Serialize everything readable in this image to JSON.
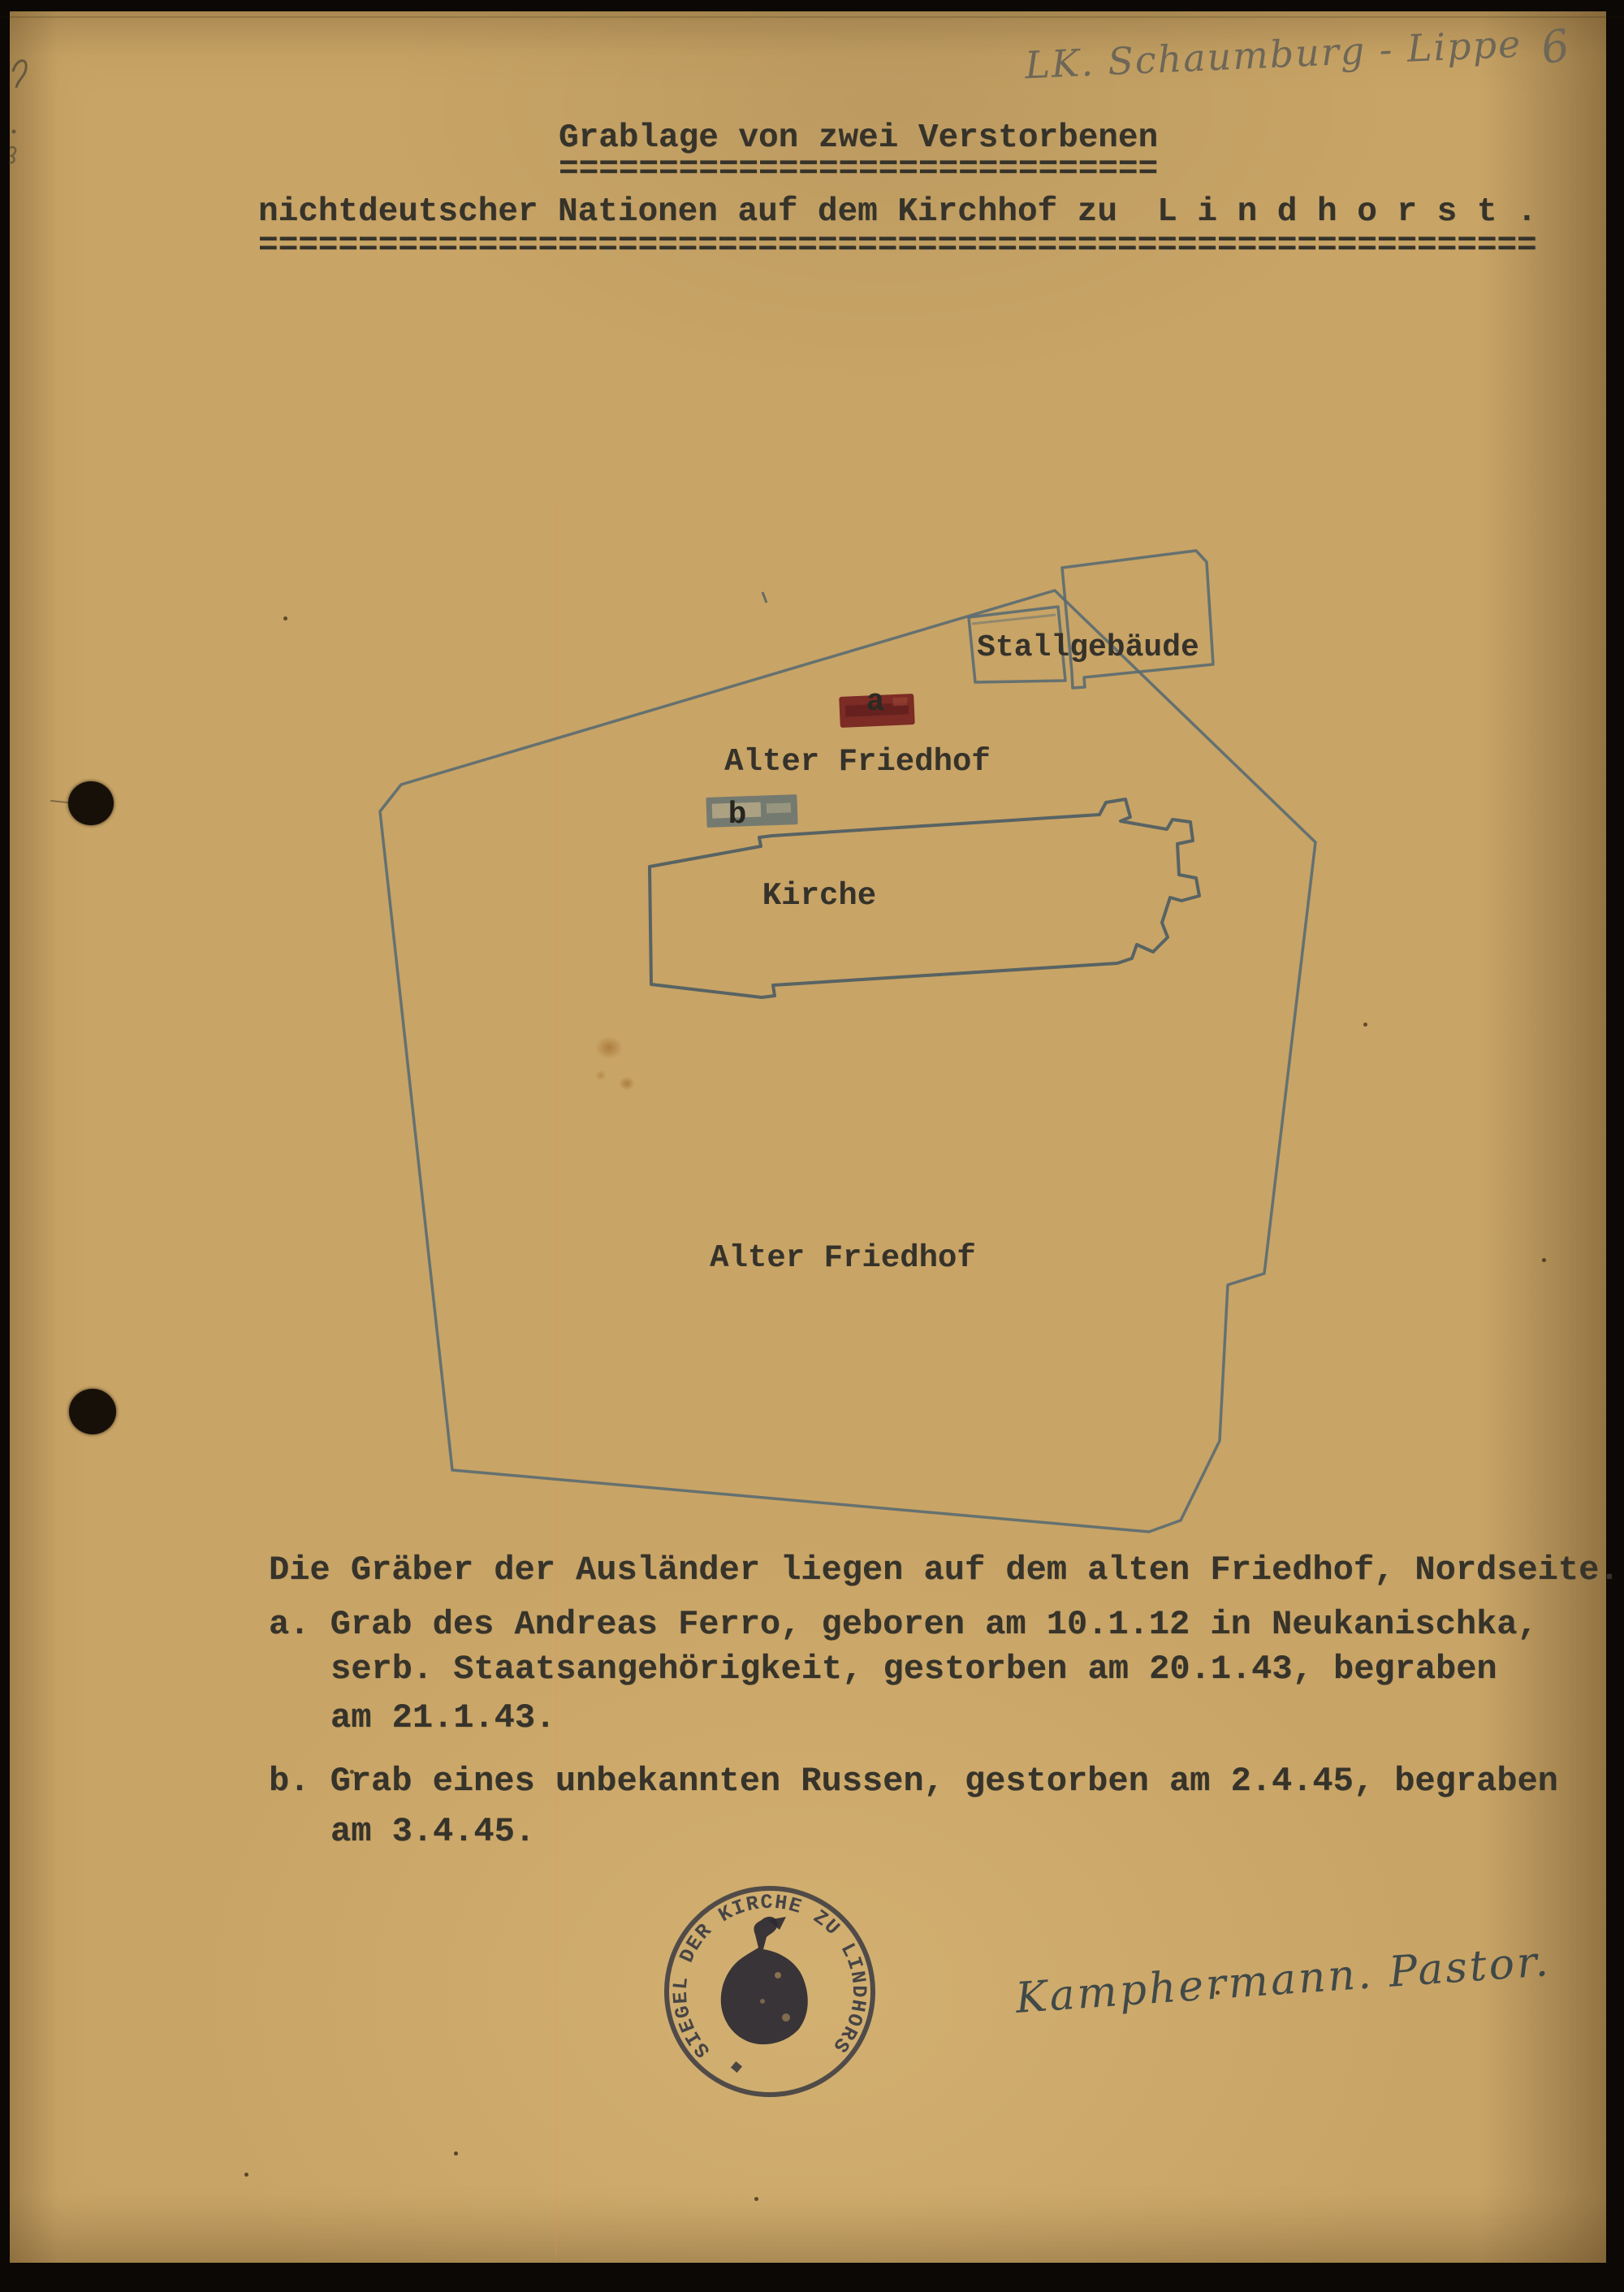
{
  "page": {
    "annotation_top_right": "LK. Schaumburg - Lippe",
    "page_number": "6",
    "title_line1": "Grablage von zwei Verstorbenen",
    "title_underline1": "==============================",
    "title_line2": "nichtdeutscher Nationen auf dem Kirchhof zu  L i n d h o r s t .",
    "title_underline2": "================================================================"
  },
  "map": {
    "labels": {
      "stall": "Stallgebäude",
      "cemetery_upper": "Alter Friedhof",
      "church": "Kirche",
      "cemetery_lower": "Alter Friedhof",
      "grave_a": "a",
      "grave_b": "b"
    },
    "colors": {
      "outline": "#5a6b71",
      "church_outline": "#4e5d63",
      "grave_a_fill": "#7c2b25",
      "grave_b_fill": "#747a70",
      "label_ink": "#35322a"
    }
  },
  "notes": {
    "intro": "Die Gräber der Ausländer liegen auf dem alten Friedhof, Nordseite.",
    "item_a_line1": "a. Grab des Andreas Ferro, geboren am 10.1.12 in Neukanischka,",
    "item_a_line2": "serb. Staatsangehörigkeit, gestorben am 20.1.43, begraben",
    "item_a_line3": "am 21.1.43.",
    "item_b_line1": "b. Grab eines unbekannten Russen, gestorben am 2.4.45, begraben",
    "item_b_line2": "am 3.4.45."
  },
  "stamp": {
    "text": "SIEGEL DER KIRCHE ZU LINDHORST"
  },
  "signature": "Kamphermann. Pastor."
}
